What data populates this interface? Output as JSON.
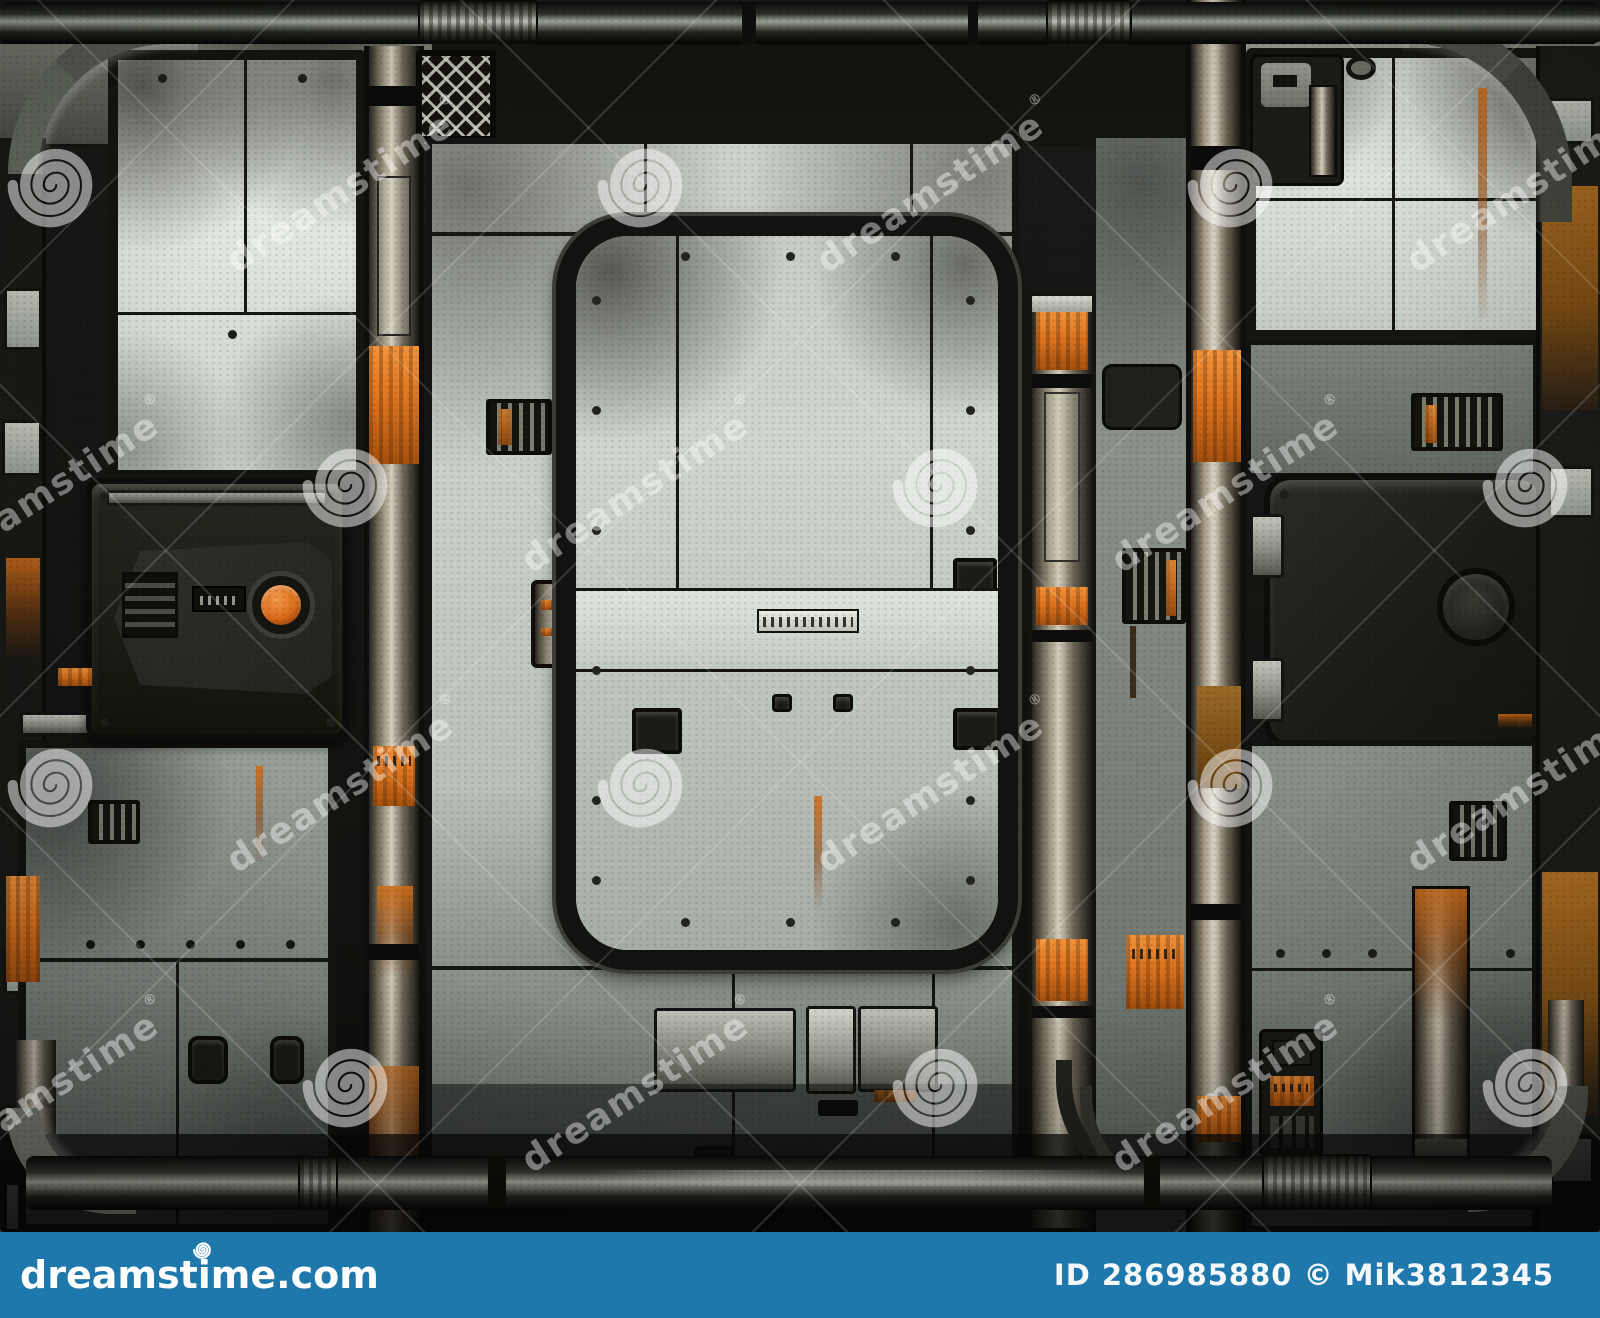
{
  "scene": {
    "description": "Grungy sci-fi industrial metal wall of riveted light-gray panels with a central sealed hatch door, rusty vertical beams, orange hazard decals, a dark control box with an orange round button, and pipes running along the top and bottom — watermarked stock-photo preview"
  },
  "watermark": {
    "text": "dreamstime",
    "reg_mark": "®",
    "spiral_icon": "dreamstime-spiral-icon"
  },
  "footer": {
    "site": "dreamstime.com",
    "credit": "ID 286985880 © Mik3812345"
  },
  "colors": {
    "footer-blue": "#1e78ab",
    "accent-orange": "#dd7420",
    "panel-light": "#d9ddd7",
    "panel-mid": "#8f968f",
    "frame-dark": "#141412",
    "metal-highlight": "#d4cdbb",
    "watermark-white": "#ffffff"
  }
}
